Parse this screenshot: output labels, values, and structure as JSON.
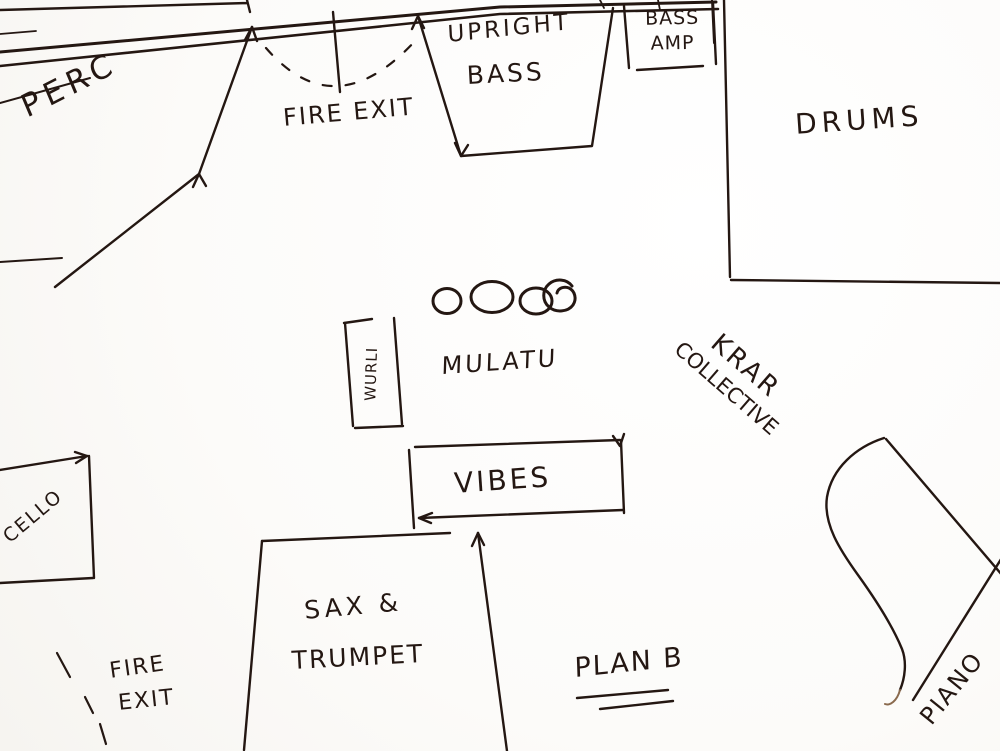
{
  "sketch": {
    "type": "hand-drawn stage plan",
    "ink_color": "#241712",
    "paper_color": "#fdfdfc"
  },
  "areas": {
    "perc": {
      "label": "PERC"
    },
    "fire_exit_top": {
      "label": "FIRE EXIT"
    },
    "upright_bass": {
      "line1": "UPRIGHT",
      "line2": "BASS"
    },
    "bass_amp": {
      "line1": "BASS",
      "line2": "AMP"
    },
    "drums": {
      "label": "DRUMS"
    },
    "mulatu": {
      "label": "MULATU"
    },
    "wurli": {
      "label": "WURLI"
    },
    "krar_collective": {
      "line1": "KRAR",
      "line2": "COLLECTIVE"
    },
    "vibes": {
      "label": "VIBES"
    },
    "cello": {
      "label": "CELLO"
    },
    "sax_trumpet": {
      "line1": "SAX &",
      "line2": "TRUMPET"
    },
    "plan_b": {
      "label": "PLAN B"
    },
    "fire_exit_bottom": {
      "line1": "FIRE",
      "line2": "EXIT"
    },
    "piano": {
      "label": "PIANO"
    }
  }
}
